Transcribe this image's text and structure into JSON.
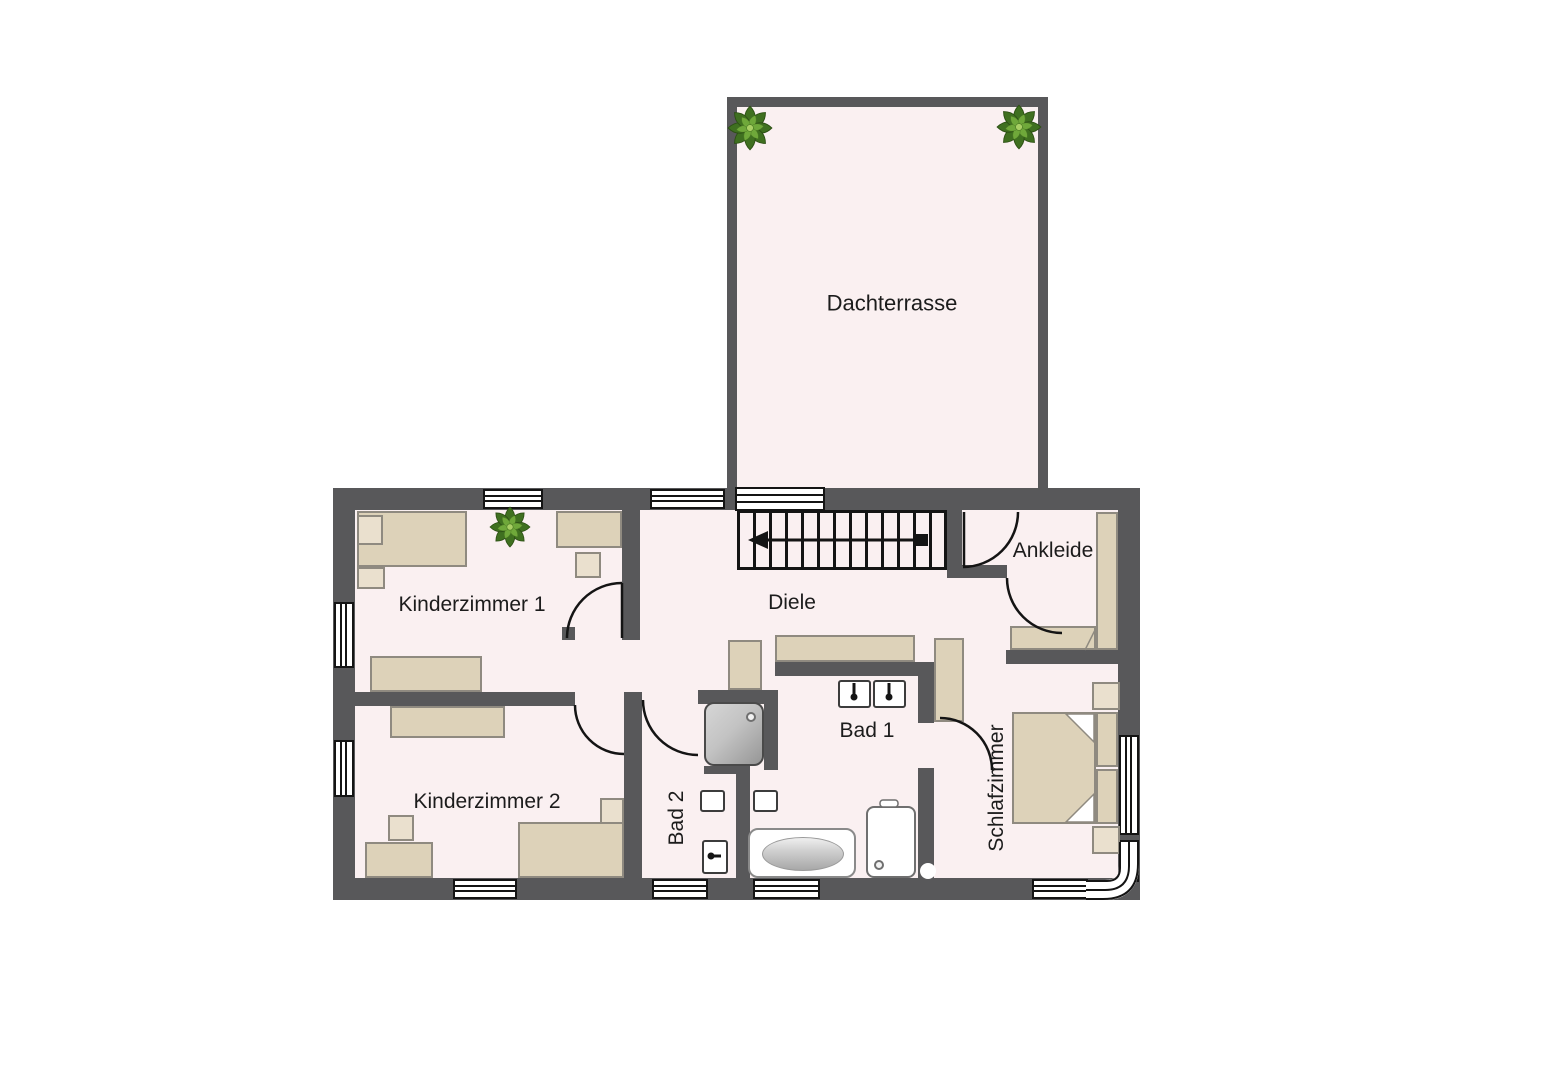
{
  "floorplan": {
    "rooms": {
      "dachterrasse": {
        "label": "Dachterrasse"
      },
      "kinderzimmer1": {
        "label": "Kinderzimmer 1"
      },
      "kinderzimmer2": {
        "label": "Kinderzimmer 2"
      },
      "diele": {
        "label": "Diele"
      },
      "ankleide": {
        "label": "Ankleide"
      },
      "bad1": {
        "label": "Bad 1"
      },
      "bad2": {
        "label": "Bad 2"
      },
      "schlafzimmer": {
        "label": "Schlafzimmer"
      }
    },
    "colors": {
      "wall": "#58585a",
      "floor": "#faf0f1",
      "outline": "#141414",
      "furniture": "#ddd2b9",
      "furniture_light": "#eae0ce",
      "furniture_border": "#8f8a80",
      "fixture_border": "#3c3c3c",
      "shower_gray_light": "#d6d6d6",
      "shower_gray_dark": "#969696",
      "plant_dark": "#3f7020",
      "plant_mid": "#6fa83a",
      "plant_light": "#a8cf63",
      "background": "#ffffff"
    },
    "icons": {
      "plant": "plant-icon",
      "stairs_direction": "stairs-direction-arrow-icon",
      "drain": "drain-icon",
      "faucet": "faucet-icon"
    }
  }
}
